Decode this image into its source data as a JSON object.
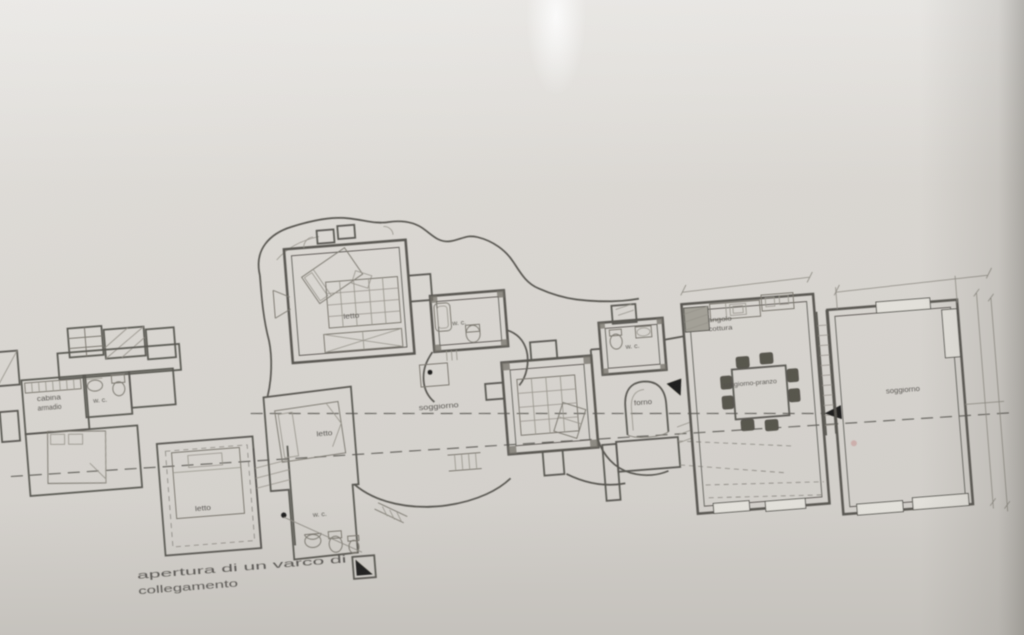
{
  "photo": {
    "description": "Photograph of a hand-drafted architectural floor plan on paper",
    "language": "Italian"
  },
  "colors": {
    "paper_top": "#e4e2de",
    "paper_bottom": "#d2cfca",
    "ink": "#56544f",
    "furniture_ink": "#7b786f",
    "marker_black": "#1f1e1a",
    "window_fill": "#e4e2dc"
  },
  "plan": {
    "labels": [
      {
        "id": "cabina-armadio",
        "lines": [
          "cabina",
          "armadio"
        ],
        "x": 52,
        "y": 364,
        "size": 7,
        "lh": 9.5,
        "len": 24
      },
      {
        "id": "wc-left",
        "text": "w. c.",
        "x": 103,
        "y": 370,
        "size": 6.5,
        "len": 14
      },
      {
        "id": "letto-sw",
        "text": "letto",
        "x": 197,
        "y": 486,
        "size": 7,
        "len": 16
      },
      {
        "id": "letto-top",
        "text": "letto",
        "x": 360,
        "y": 306,
        "size": 7,
        "len": 16
      },
      {
        "id": "wc-top",
        "text": "w. c.",
        "x": 467,
        "y": 321,
        "size": 6.5,
        "len": 14
      },
      {
        "id": "letto-center",
        "text": "letto",
        "x": 324,
        "y": 421,
        "size": 7,
        "len": 16
      },
      {
        "id": "soggiorno-center",
        "text": "soggiorno",
        "x": 440,
        "y": 403,
        "size": 7,
        "len": 40
      },
      {
        "id": "wc-center",
        "text": "w. c.",
        "x": 313,
        "y": 501,
        "size": 6.5,
        "len": 14
      },
      {
        "id": "wc-right",
        "text": "w. c.",
        "x": 638,
        "y": 358,
        "size": 6.5,
        "len": 14
      },
      {
        "id": "forno",
        "text": "forno",
        "x": 644,
        "y": 415,
        "size": 7,
        "len": 18
      },
      {
        "id": "angolo-cottura",
        "lines": [
          "angolo",
          "cottura"
        ],
        "x": 727,
        "y": 338,
        "size": 6.5,
        "lh": 9,
        "len": 24
      },
      {
        "id": "soggiorno-pranzo",
        "text": "soggiorno-pranzo",
        "x": 752,
        "y": 404,
        "size": 6.5,
        "len": 54
      },
      {
        "id": "soggiorno-right",
        "text": "soggiorno",
        "x": 904,
        "y": 423,
        "size": 7,
        "len": 34
      }
    ],
    "annotation": {
      "id": "apertura-note",
      "lines": [
        "apertura di un varco di",
        "collegamento"
      ],
      "x": 126,
      "y": 549,
      "size": 10.5,
      "lh": 15.5,
      "len": [
        210,
        100
      ]
    }
  }
}
